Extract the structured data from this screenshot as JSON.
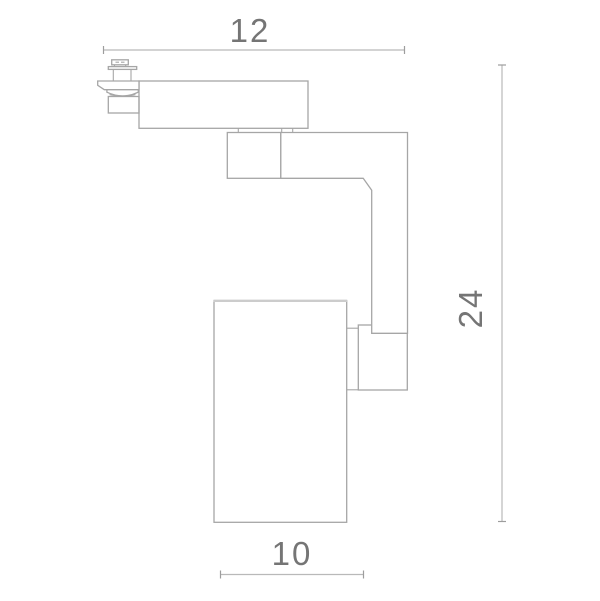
{
  "drawing": {
    "title": "Track spotlight dimensional drawing",
    "dimensions": {
      "top_width": "12",
      "right_height": "24",
      "bottom_width": "10"
    },
    "style": {
      "outline_color": "#a6a6a6",
      "dimension_line_color": "#b9b9b9",
      "text_color": "#757575",
      "background": "#ffffff"
    },
    "parts": [
      "track-adapter",
      "housing",
      "gimbal-block",
      "swivel-arm",
      "mount-block",
      "lamp-cylinder"
    ]
  }
}
